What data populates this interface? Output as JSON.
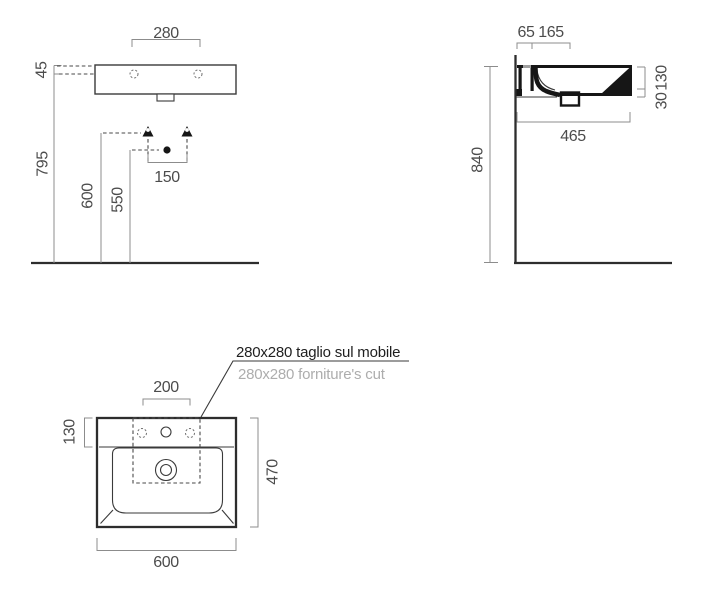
{
  "colors": {
    "line": "#3a3a3a",
    "heavy_line": "#161616",
    "dimension_line": "#8c8c8c",
    "label_text": "#4c4c4c",
    "note_text": "#1f1f1f",
    "note_text_muted": "#adadad",
    "background": "#ffffff"
  },
  "views": {
    "front": {
      "fixing_holes_spacing": "280",
      "rim_to_fixing_holes": "45",
      "fixing_holes_height": "795",
      "connection_height_left": "600",
      "drain_connection_height": "550",
      "connections_spacing": "150"
    },
    "side": {
      "tap_hole_offset": "65",
      "drain_offset": "165",
      "basin_edge_depth": "130",
      "front_lip_depth": "30",
      "rim_height": "840",
      "overall_depth": "465"
    },
    "plan": {
      "tap_holes_spacing": "200",
      "deck_depth": "130",
      "overall_depth": "470",
      "overall_width": "600",
      "cut_note_primary": "280x280 taglio sul mobile",
      "cut_note_secondary": "280x280 forniture's cut"
    }
  }
}
